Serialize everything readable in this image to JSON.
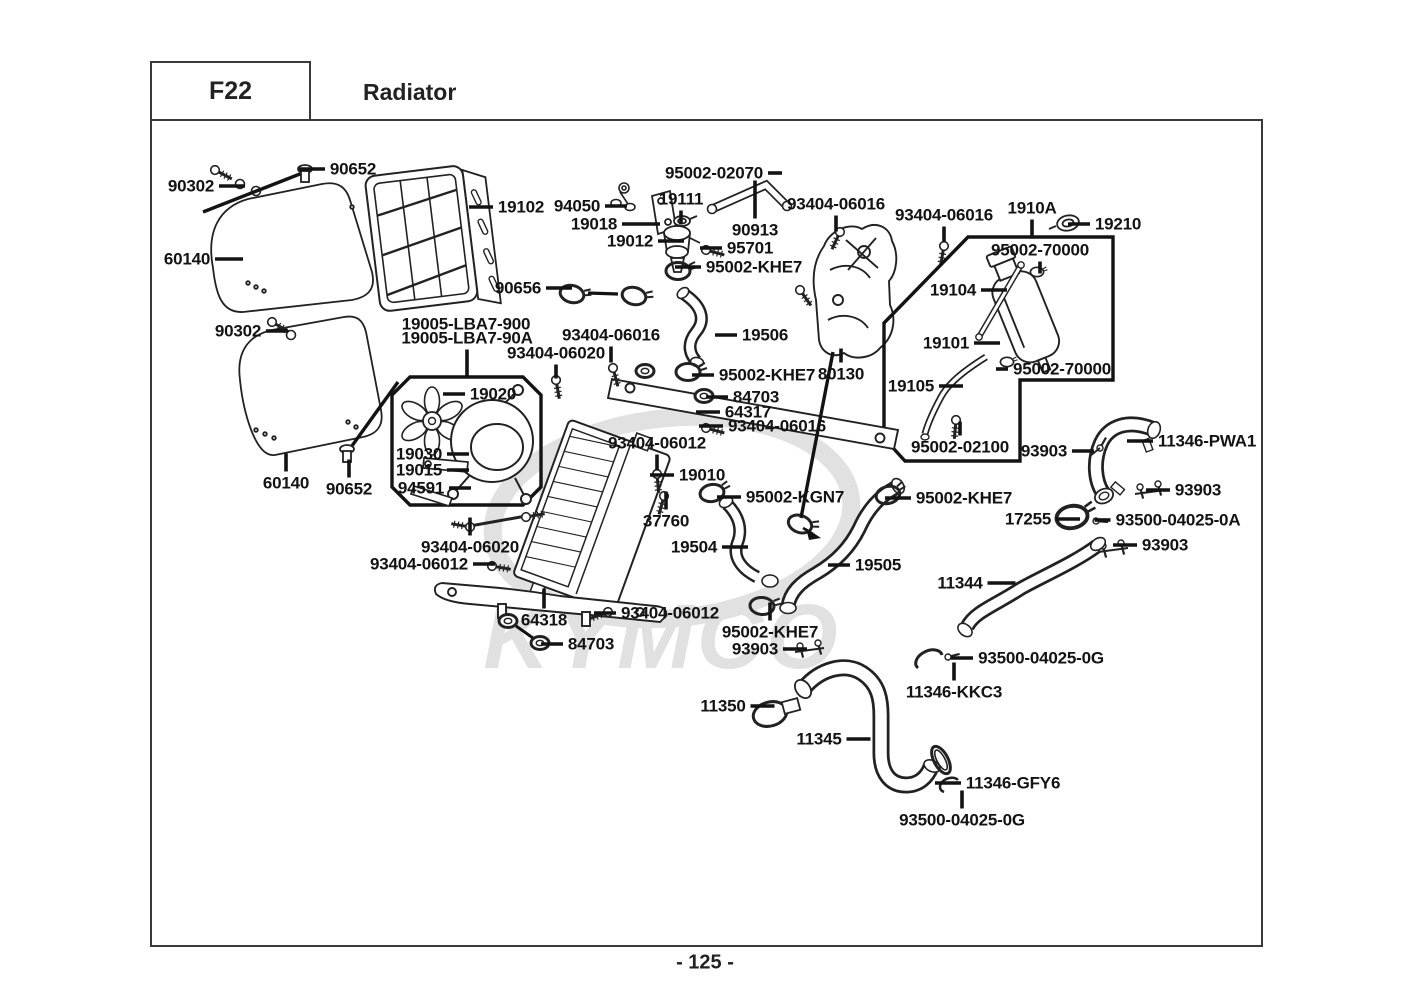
{
  "header": {
    "code": "F22",
    "title": "Radiator"
  },
  "footer": {
    "page_number": "- 125 -"
  },
  "watermark": {
    "text": "KYMCO"
  },
  "colors": {
    "line": "#222222",
    "label": "#131313",
    "frame": "#3a3a3a",
    "watermark": "#c9c9c9"
  },
  "diagram": {
    "labels": [
      {
        "text": "90302",
        "x": 191,
        "y": 186,
        "leader": {
          "side": "right",
          "len": 26
        }
      },
      {
        "text": "90652",
        "x": 353,
        "y": 169,
        "leader": {
          "side": "left",
          "len": 26
        }
      },
      {
        "text": "60140",
        "x": 187,
        "y": 259,
        "leader": {
          "side": "right",
          "len": 28
        }
      },
      {
        "text": "19102",
        "x": 521,
        "y": 207,
        "leader": {
          "side": "left",
          "len": 24
        }
      },
      {
        "text": "94050",
        "x": 577,
        "y": 206,
        "leader": {
          "side": "right",
          "len": 22
        }
      },
      {
        "text": "19018",
        "x": 594,
        "y": 224,
        "leader": {
          "side": "right",
          "len": 38
        }
      },
      {
        "text": "19012",
        "x": 630,
        "y": 241,
        "leader": {
          "side": "right",
          "len": 26
        }
      },
      {
        "text": "19111",
        "x": 681,
        "y": 199,
        "leader": {
          "side": "down",
          "len": 14
        }
      },
      {
        "text": "95002-02070",
        "x": 714,
        "y": 173,
        "leader": {
          "side": "right",
          "len": 14
        }
      },
      {
        "text": "90913",
        "x": 755,
        "y": 230,
        "leader": {
          "side": "up",
          "len": 38
        }
      },
      {
        "text": "95701",
        "x": 750,
        "y": 248,
        "leader": {
          "side": "left",
          "len": 22
        }
      },
      {
        "text": "95002-KHE7",
        "x": 754,
        "y": 267,
        "leader": {
          "side": "left",
          "len": 26
        }
      },
      {
        "text": "93404-06016",
        "x": 836,
        "y": 204,
        "leader": {
          "side": "down",
          "len": 16
        }
      },
      {
        "text": "93404-06016",
        "x": 944,
        "y": 215,
        "leader": {
          "side": "down",
          "len": 16
        }
      },
      {
        "text": "1910A",
        "x": 1032,
        "y": 208,
        "leader": {
          "side": "down",
          "len": 18
        }
      },
      {
        "text": "19210",
        "x": 1118,
        "y": 224,
        "leader": {
          "side": "left",
          "len": 22
        }
      },
      {
        "text": "95002-70000",
        "x": 1040,
        "y": 250,
        "leader": {
          "side": "down",
          "len": 12
        }
      },
      {
        "text": "19104",
        "x": 953,
        "y": 290,
        "leader": {
          "side": "right",
          "len": 26
        }
      },
      {
        "text": "19101",
        "x": 946,
        "y": 343,
        "leader": {
          "side": "right",
          "len": 26
        }
      },
      {
        "text": "95002-70000",
        "x": 1062,
        "y": 369,
        "leader": {
          "side": "left",
          "len": 12
        }
      },
      {
        "text": "19105",
        "x": 911,
        "y": 386,
        "leader": {
          "side": "right",
          "len": 24
        }
      },
      {
        "text": "95002-02100",
        "x": 960,
        "y": 447,
        "leader": {
          "side": "up",
          "len": 14
        }
      },
      {
        "text": "93903",
        "x": 1044,
        "y": 451,
        "leader": {
          "side": "right",
          "len": 22
        }
      },
      {
        "text": "11346-PWA1",
        "x": 1207,
        "y": 441,
        "leader": {
          "side": "left",
          "len": 26
        }
      },
      {
        "text": "93903",
        "x": 1198,
        "y": 490,
        "leader": {
          "side": "left",
          "len": 24
        }
      },
      {
        "text": "17255",
        "x": 1028,
        "y": 519,
        "leader": {
          "side": "right",
          "len": 24
        }
      },
      {
        "text": "93500-04025-0A",
        "x": 1178,
        "y": 520,
        "leader": {
          "side": "left",
          "len": 16
        }
      },
      {
        "text": "93903",
        "x": 1165,
        "y": 545,
        "leader": {
          "side": "left",
          "len": 24
        }
      },
      {
        "text": "90656",
        "x": 518,
        "y": 288,
        "leader": {
          "side": "right",
          "len": 26
        }
      },
      {
        "text": "19005-LBA7-900",
        "x": 466,
        "y": 324,
        "leader": null
      },
      {
        "text": "19005-LBA7-90A",
        "x": 467,
        "y": 338,
        "leader": {
          "side": "down",
          "len": 26
        }
      },
      {
        "text": "93404-06016",
        "x": 611,
        "y": 335,
        "leader": {
          "side": "down",
          "len": 16
        }
      },
      {
        "text": "93404-06020",
        "x": 556,
        "y": 353,
        "leader": {
          "side": "down",
          "len": 14
        }
      },
      {
        "text": "19506",
        "x": 765,
        "y": 335,
        "leader": {
          "side": "left",
          "len": 22
        }
      },
      {
        "text": "95002-KHE7",
        "x": 767,
        "y": 375,
        "leader": {
          "side": "left",
          "len": 22
        }
      },
      {
        "text": "80130",
        "x": 841,
        "y": 374,
        "leader": {
          "side": "up",
          "len": 14
        }
      },
      {
        "text": "84703",
        "x": 756,
        "y": 397,
        "leader": {
          "side": "left",
          "len": 22
        }
      },
      {
        "text": "64317",
        "x": 748,
        "y": 412,
        "leader": {
          "side": "left",
          "len": 24
        }
      },
      {
        "text": "93404-06016",
        "x": 777,
        "y": 426,
        "leader": {
          "side": "left",
          "len": 24
        }
      },
      {
        "text": "93404-06012",
        "x": 657,
        "y": 443,
        "leader": {
          "side": "down",
          "len": 16
        }
      },
      {
        "text": "19010",
        "x": 702,
        "y": 475,
        "leader": {
          "side": "left",
          "len": 24
        }
      },
      {
        "text": "37760",
        "x": 666,
        "y": 521,
        "leader": {
          "side": "up",
          "len": 18
        }
      },
      {
        "text": "95002-KGN7",
        "x": 795,
        "y": 497,
        "leader": {
          "side": "left",
          "len": 24
        }
      },
      {
        "text": "19504",
        "x": 694,
        "y": 547,
        "leader": {
          "side": "right",
          "len": 26
        }
      },
      {
        "text": "95002-KHE7",
        "x": 964,
        "y": 498,
        "leader": {
          "side": "left",
          "len": 26
        }
      },
      {
        "text": "19505",
        "x": 878,
        "y": 565,
        "leader": {
          "side": "left",
          "len": 22
        }
      },
      {
        "text": "11344",
        "x": 960,
        "y": 583,
        "leader": {
          "side": "right",
          "len": 28
        }
      },
      {
        "text": "93500-04025-0G",
        "x": 1041,
        "y": 658,
        "leader": {
          "side": "left",
          "len": 22
        }
      },
      {
        "text": "11346-KKC3",
        "x": 954,
        "y": 692,
        "leader": {
          "side": "up",
          "len": 18
        }
      },
      {
        "text": "95002-KHE7",
        "x": 770,
        "y": 632,
        "leader": {
          "side": "up",
          "len": 18
        }
      },
      {
        "text": "93903",
        "x": 755,
        "y": 649,
        "leader": {
          "side": "right",
          "len": 24
        }
      },
      {
        "text": "11350",
        "x": 723,
        "y": 706,
        "leader": {
          "side": "right",
          "len": 24
        }
      },
      {
        "text": "11345",
        "x": 819,
        "y": 739,
        "leader": {
          "side": "right",
          "len": 24
        }
      },
      {
        "text": "11346-GFY6",
        "x": 1013,
        "y": 783,
        "leader": {
          "side": "left",
          "len": 26
        }
      },
      {
        "text": "93500-04025-0G",
        "x": 962,
        "y": 820,
        "leader": {
          "side": "up",
          "len": 18
        }
      },
      {
        "text": "64318",
        "x": 544,
        "y": 620,
        "leader": {
          "side": "up",
          "len": 20
        }
      },
      {
        "text": "84703",
        "x": 591,
        "y": 644,
        "leader": {
          "side": "left",
          "len": 22
        }
      },
      {
        "text": "93404-06012",
        "x": 670,
        "y": 613,
        "leader": {
          "side": "left",
          "len": 22
        }
      },
      {
        "text": "93404-06020",
        "x": 470,
        "y": 547,
        "leader": {
          "side": "up",
          "len": 18
        }
      },
      {
        "text": "93404-06012",
        "x": 419,
        "y": 564,
        "leader": {
          "side": "right",
          "len": 22
        }
      },
      {
        "text": "19020",
        "x": 493,
        "y": 394,
        "leader": {
          "side": "left",
          "len": 22
        }
      },
      {
        "text": "19030",
        "x": 419,
        "y": 454,
        "leader": {
          "side": "right",
          "len": 22
        }
      },
      {
        "text": "19015",
        "x": 419,
        "y": 470,
        "leader": {
          "side": "right",
          "len": 22
        }
      },
      {
        "text": "94591",
        "x": 421,
        "y": 488,
        "leader": {
          "side": "right",
          "len": 22
        }
      },
      {
        "text": "90302",
        "x": 238,
        "y": 331,
        "leader": {
          "side": "right",
          "len": 22
        }
      },
      {
        "text": "60140",
        "x": 286,
        "y": 483,
        "leader": {
          "side": "up",
          "len": 18
        }
      },
      {
        "text": "90652",
        "x": 349,
        "y": 489,
        "leader": {
          "side": "up",
          "len": 18
        }
      }
    ]
  }
}
